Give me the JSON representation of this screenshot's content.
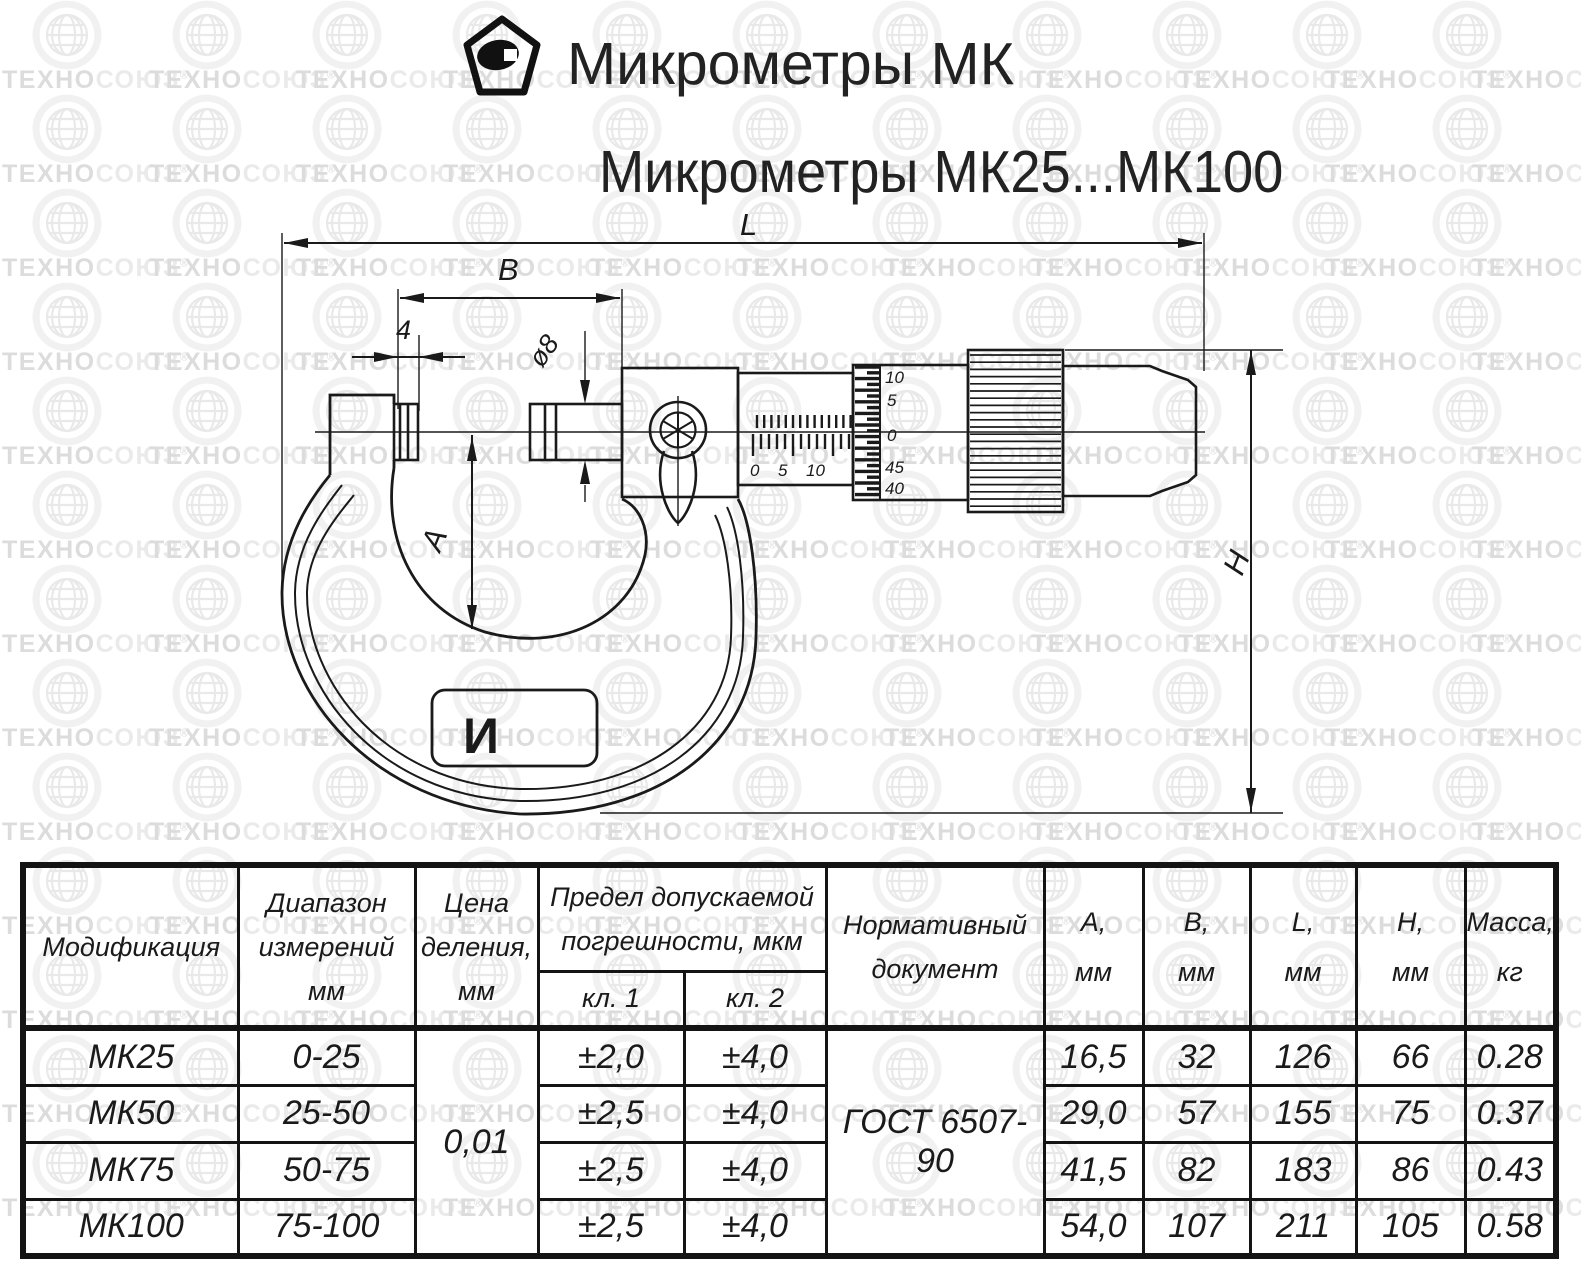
{
  "header": {
    "title": "Микрометры МК",
    "subtitle": "Микрометры МК25...МК100"
  },
  "watermark": {
    "part1": "ТЕХНО",
    "part2": "СОЮЗ",
    "reg": "®"
  },
  "drawing": {
    "dims": {
      "length": "L",
      "width_b": "B",
      "anvil_width": "4",
      "spindle_dia": "ø8",
      "depth_a": "A",
      "height_h": "H"
    },
    "sleeve_scale": [
      "0",
      "5",
      "10"
    ],
    "thimble_scale": [
      "10",
      "5",
      "0",
      "45",
      "40"
    ],
    "frame_mark": "И"
  },
  "table": {
    "headers": {
      "modification": "Модификация",
      "range": [
        "Диапазон",
        "измерений",
        "мм"
      ],
      "division": [
        "Цена",
        "деления,",
        "мм"
      ],
      "error": [
        "Предел допускаемой",
        "погрешности, мкм"
      ],
      "class1": "кл. 1",
      "class2": "кл. 2",
      "document": [
        "Нормативный",
        "документ"
      ],
      "a": [
        "А,",
        "мм"
      ],
      "b": [
        "В,",
        "мм"
      ],
      "l": [
        "L,",
        "мм"
      ],
      "h": [
        "Н,",
        "мм"
      ],
      "mass": [
        "Масса,",
        "кг"
      ]
    },
    "shared": {
      "division_value": "0,01",
      "document_value": "ГОСТ 6507-90"
    },
    "rows": [
      {
        "model": "МК25",
        "range": "0-25",
        "cl1": "±2,0",
        "cl2": "±4,0",
        "a": "16,5",
        "b": "32",
        "l": "126",
        "h": "66",
        "mass": "0.28"
      },
      {
        "model": "МК50",
        "range": "25-50",
        "cl1": "±2,5",
        "cl2": "±4,0",
        "a": "29,0",
        "b": "57",
        "l": "155",
        "h": "75",
        "mass": "0.37"
      },
      {
        "model": "МК75",
        "range": "50-75",
        "cl1": "±2,5",
        "cl2": "±4,0",
        "a": "41,5",
        "b": "82",
        "l": "183",
        "h": "86",
        "mass": "0.43"
      },
      {
        "model": "МК100",
        "range": "75-100",
        "cl1": "±2,5",
        "cl2": "±4,0",
        "a": "54,0",
        "b": "107",
        "l": "211",
        "h": "105",
        "mass": "0.58"
      }
    ]
  }
}
